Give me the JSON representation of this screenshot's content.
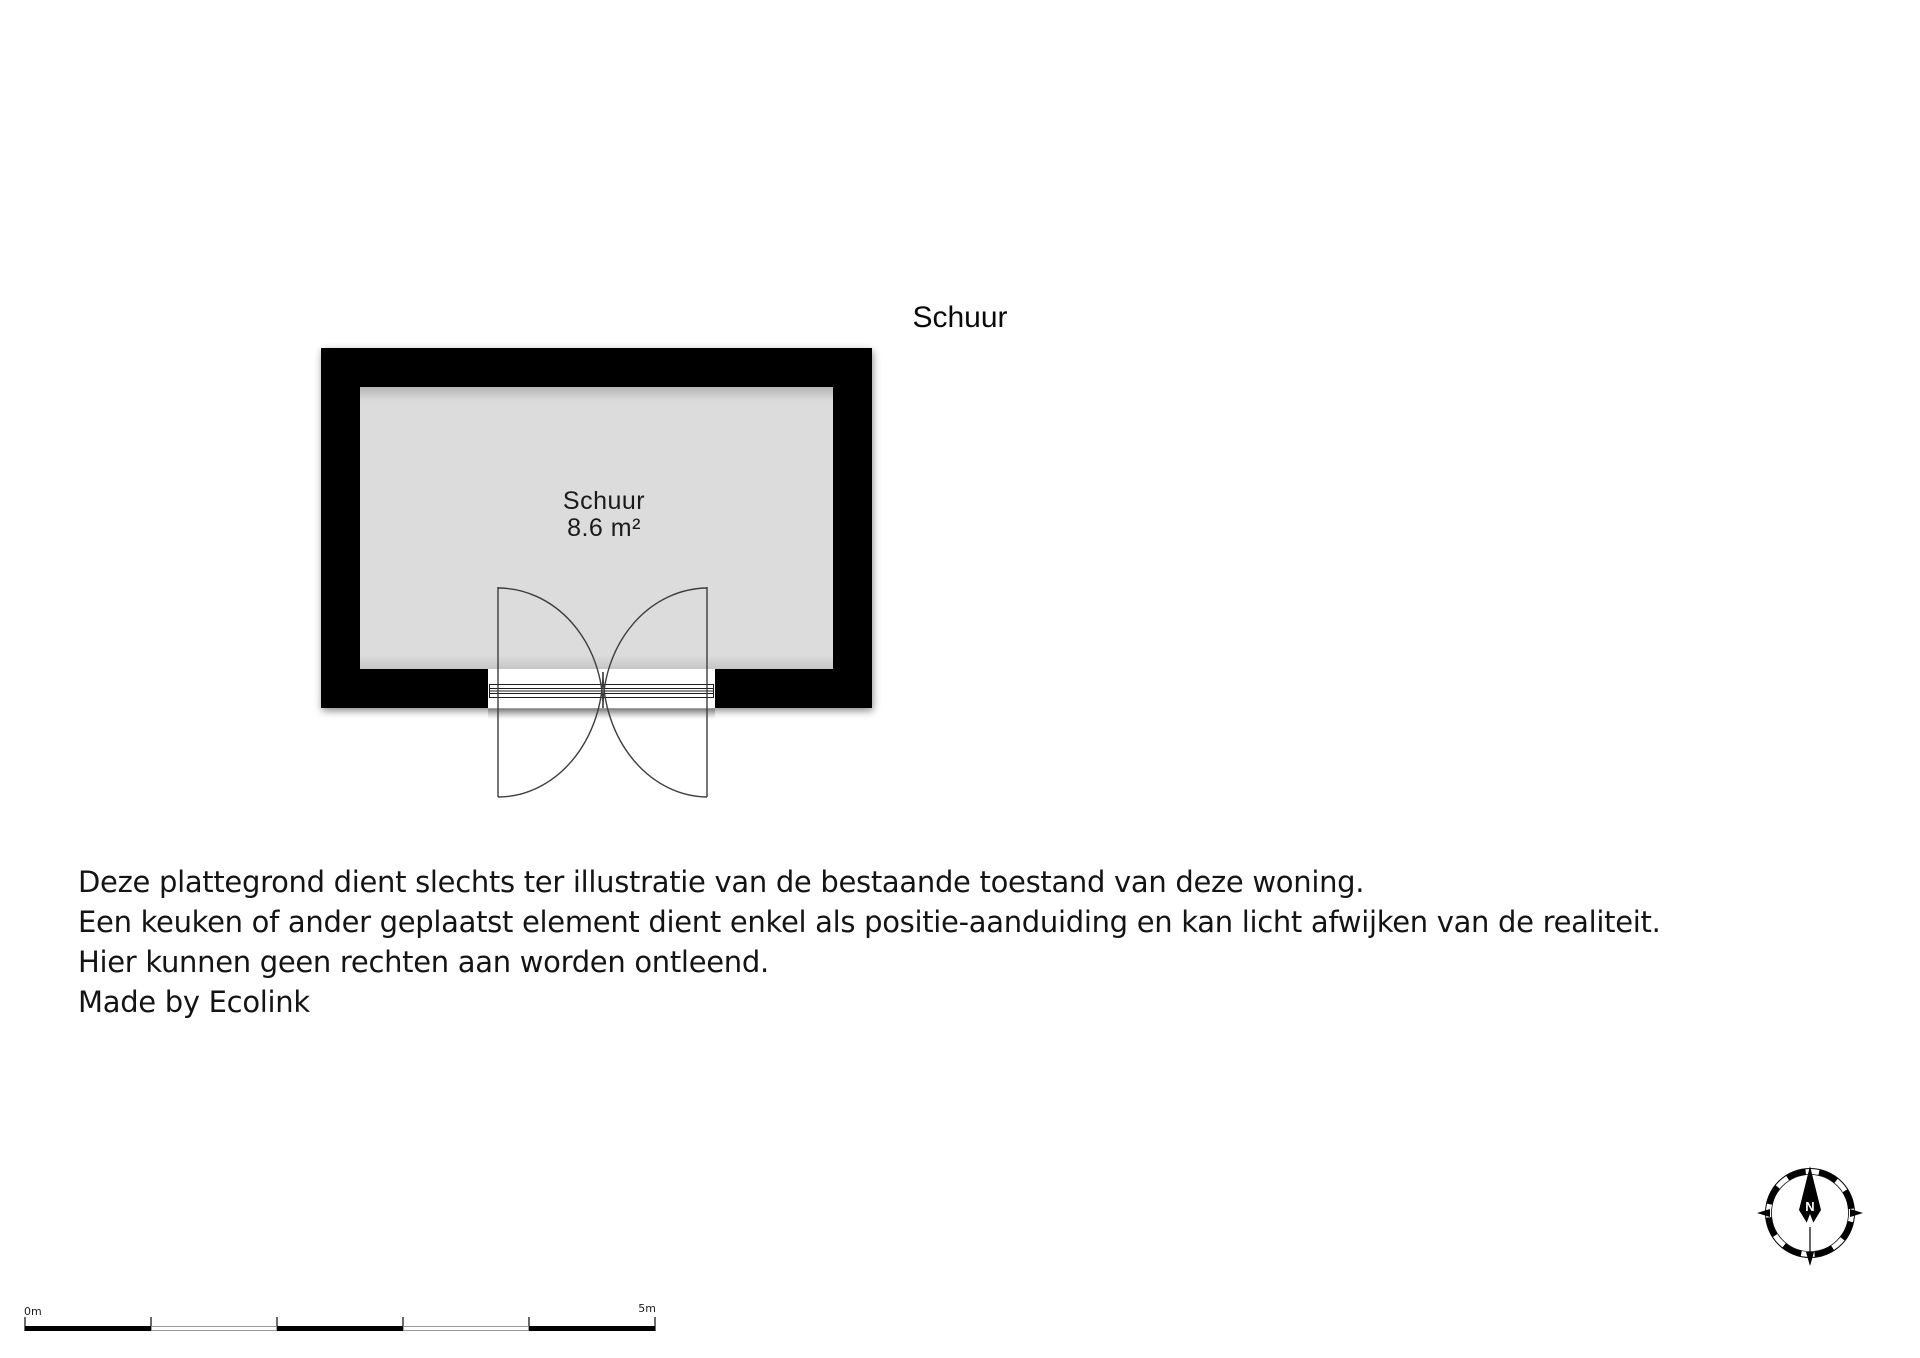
{
  "plan": {
    "title": "Schuur",
    "room": {
      "name": "Schuur",
      "area": "8.6 m²"
    },
    "colors": {
      "wall": "#000000",
      "floor": "#dcdcdc",
      "background": "#ffffff",
      "line": "#3d3d3d"
    }
  },
  "disclaimer": {
    "lines": [
      "Deze plattegrond dient slechts ter illustratie van de bestaande toestand van deze woning.",
      "Een keuken of ander geplaatst element dient enkel als positie-aanduiding en kan licht afwijken van de realiteit.",
      "Hier kunnen geen rechten aan worden ontleend.",
      "Made by Ecolink"
    ]
  },
  "compass": {
    "north_label": "N"
  },
  "scale_bar": {
    "start_label": "0m",
    "end_label": "5m"
  }
}
